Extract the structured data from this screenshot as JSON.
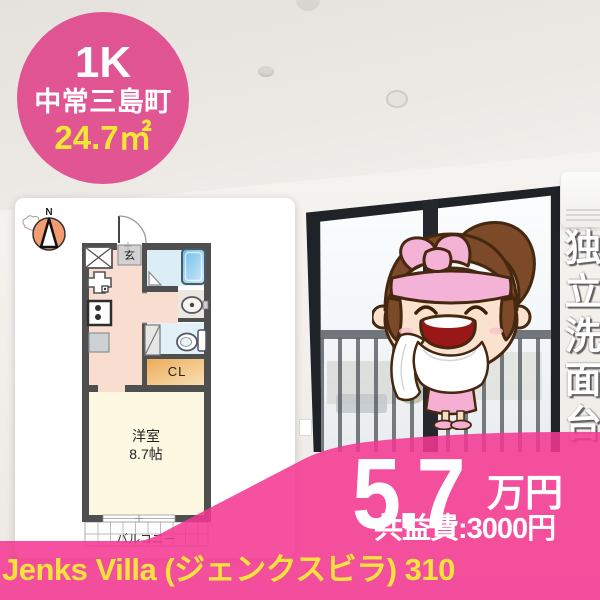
{
  "badge": {
    "layout": "1K",
    "location": "中常三島町",
    "area": "24.7㎡"
  },
  "feature": {
    "text": "独立洗面台"
  },
  "price": {
    "amount": "5.7",
    "unit": "万円",
    "fee_label": "共益費:3000円"
  },
  "title": {
    "text": "Jenks Villa (ジェンクスビラ) 310"
  },
  "floorplan": {
    "compass": "N",
    "entrance": "玄",
    "closet": "CL",
    "room_name": "洋室",
    "room_size": "8.7帖",
    "balcony": "バルコニー"
  },
  "colors": {
    "badge_pink": "#E05C93",
    "banner_pink": "#F3379A",
    "accent_yellow": "#F4E33C",
    "text_white": "#FFFFFF"
  }
}
